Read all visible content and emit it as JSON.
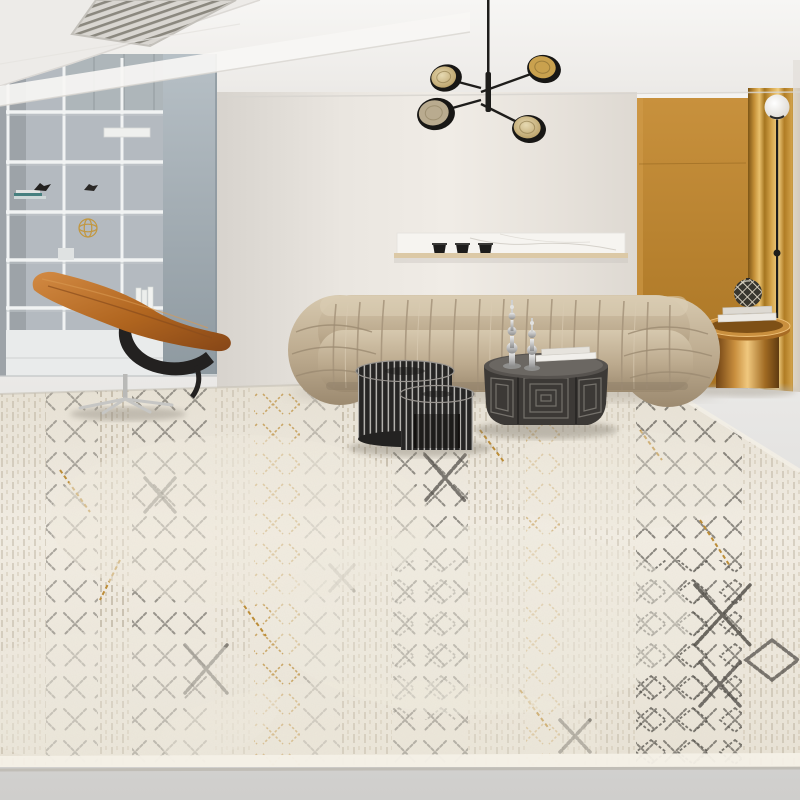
{
  "meta": {
    "scene": "Modern living room interior photograph",
    "subject": "Cream distressed Moroccan-style area rug in a styled living room"
  },
  "palette": {
    "ceiling": "#f4f3f1",
    "wall_center": "#eae6e0",
    "wall_left": "#b4bac0",
    "panel_blue_gray": "#a9b3ba",
    "wall_mustard": "#bb8531",
    "curtain_gold": "#c9983f",
    "floor": "#dfdedc",
    "rug_base": "#efeadf",
    "rug_motif_dark": "#514e48",
    "rug_motif_gold": "#bd8c34",
    "rug_motif_gray": "#a89c86",
    "sofa_fabric": "#c2b096",
    "chair_leather": "#b2641f",
    "chair_frame": "#232120",
    "table_slat_black": "#262524",
    "coffee_table_bronze": "#3c3936",
    "side_table_copper": "#c98f3e",
    "chandelier_black": "#1e1d1b",
    "shelf_white": "#f1f3f3",
    "marble_shelf": "#f6f4f0",
    "lamp_globe": "#f4f2ee"
  },
  "objects": {
    "ceiling": {
      "label": "white ceiling with soffit and linear air vent"
    },
    "chandelier": {
      "label": "black mid-century chandelier with four gold disc shades"
    },
    "shelving": {
      "label": "white open shelving unit with books and figurines"
    },
    "lounge_chair": {
      "label": "cognac leather swivel lounge chair with chrome base"
    },
    "sofa": {
      "label": "beige channel-tufted fabric sofa"
    },
    "wall_shelf": {
      "label": "floating shelf with marble back panel and black cups"
    },
    "nesting_tables": {
      "label": "black slatted round nesting side tables"
    },
    "coffee_table": {
      "label": "dark octagonal coffee table with concentric square pattern"
    },
    "candlesticks": {
      "label": "two silver turned candlestick ornaments"
    },
    "side_table": {
      "label": "copper drum side table with books and patterned sphere"
    },
    "floor_lamp": {
      "label": "slim black floor lamp with glass globe"
    },
    "accent_wall": {
      "label": "mustard accent wall with gold curtain panel"
    },
    "rug": {
      "label": "cream Moroccan-style distressed rug with charcoal and gold motifs"
    },
    "floor": {
      "label": "light grey floor"
    }
  }
}
